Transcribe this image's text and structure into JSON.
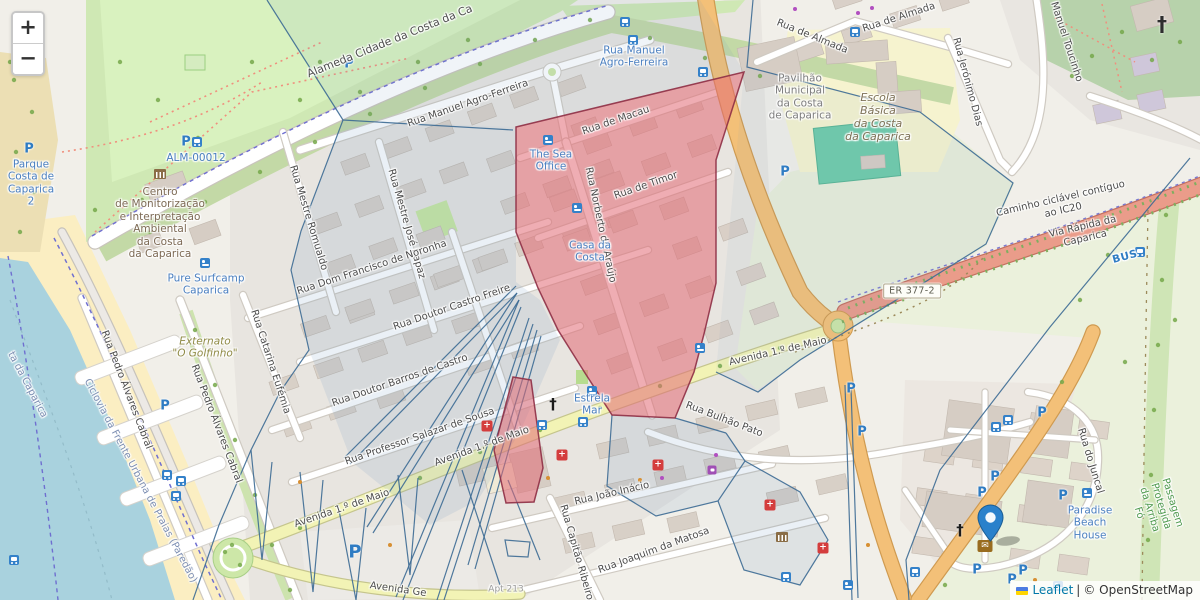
{
  "controls": {
    "zoom_in_label": "+",
    "zoom_out_label": "−"
  },
  "attribution": {
    "flag": "ukraine-flag",
    "leaflet_link": "Leaflet",
    "separator": "|",
    "osm_text": "© OpenStreetMap"
  },
  "route_badge": {
    "text": "ER 377-2"
  },
  "colors": {
    "highlight_fill": "#E26A74",
    "highlight_stroke": "#8E2F45",
    "overlay_line": "#3C6A94",
    "overlay_tint": "#6D94BD",
    "marker_blue": "#2A81CB",
    "water": "#A9D2DE",
    "beach": "#FBEEC2",
    "park_green": "#CFE8B4",
    "road_orange": "#F3C078",
    "road_yellow": "#F2F3B5",
    "road_trunk": "#EA9C8A",
    "poi_blue": "#4A7FC0"
  },
  "street_labels": [
    {
      "text": "Alameda Cidade da Costa da Ca",
      "x": 390,
      "y": 42,
      "rot": -22,
      "cls": "big"
    },
    {
      "text": "Rua Manuel Agro-Ferreira",
      "x": 468,
      "y": 104,
      "rot": -19
    },
    {
      "text": "Rua de Macau",
      "x": 616,
      "y": 121,
      "rot": -19
    },
    {
      "text": "Rua de Timor",
      "x": 646,
      "y": 186,
      "rot": -19
    },
    {
      "text": "Rua Norberto de Araújo",
      "x": 600,
      "y": 225,
      "rot": 78
    },
    {
      "text": "Rua Mestre Romualdo",
      "x": 308,
      "y": 218,
      "rot": 73
    },
    {
      "text": "Rua Mestre José Rapaz",
      "x": 406,
      "y": 224,
      "rot": 74
    },
    {
      "text": "Rua Dom Francisco de Noronha",
      "x": 372,
      "y": 268,
      "rot": -18
    },
    {
      "text": "Rua Doutor Castro Freire",
      "x": 452,
      "y": 308,
      "rot": -19
    },
    {
      "text": "Rua Doutor Barros de Castro",
      "x": 400,
      "y": 381,
      "rot": -19
    },
    {
      "text": "Rua Professor Salazar de Sousa",
      "x": 420,
      "y": 437,
      "rot": -19
    },
    {
      "text": "Rua Catarina Eufémia",
      "x": 270,
      "y": 362,
      "rot": 72
    },
    {
      "text": "Rua Pedro Álvares Cabral",
      "x": 126,
      "y": 390,
      "rot": 69
    },
    {
      "text": "Rua Pedro Álvares Cabral",
      "x": 216,
      "y": 424,
      "rot": 69
    },
    {
      "text": "Avenida 1.º de Maio",
      "x": 482,
      "y": 447,
      "rot": -20
    },
    {
      "text": "Avenida 1.º de Maio",
      "x": 342,
      "y": 509,
      "rot": -19
    },
    {
      "text": "Avenida 1.º de Maio",
      "x": 778,
      "y": 352,
      "rot": -13
    },
    {
      "text": "Rua Bulhão Pato",
      "x": 724,
      "y": 420,
      "rot": 21
    },
    {
      "text": "Rua João Inácio",
      "x": 612,
      "y": 494,
      "rot": -13
    },
    {
      "text": "Rua Joaquim da Matosa",
      "x": 654,
      "y": 551,
      "rot": -20
    },
    {
      "text": "Rua Capitão Ribeiro de",
      "x": 578,
      "y": 560,
      "rot": 74
    },
    {
      "text": "Avenida Ge",
      "x": 398,
      "y": 590,
      "rot": 8
    },
    {
      "text": "Rua de Almada",
      "x": 812,
      "y": 37,
      "rot": 22
    },
    {
      "text": "Rua de Almada",
      "x": 899,
      "y": 18,
      "rot": -18
    },
    {
      "text": "Rua Jerónimo Dias",
      "x": 967,
      "y": 82,
      "rot": 75
    },
    {
      "text": "Manuel Toucinho",
      "x": 1066,
      "y": 42,
      "rot": 72
    },
    {
      "text": "Caminho ciclável contíguo ao IC20",
      "x": 1062,
      "y": 205,
      "rot": -13
    },
    {
      "text": "Via Rápida da Caparica",
      "x": 1084,
      "y": 233,
      "rot": -13
    },
    {
      "text": "Rua do Juncal",
      "x": 1090,
      "y": 461,
      "rot": 73
    },
    {
      "text": "Ciclovia da Frente Urbana de Praias (Paredão)",
      "x": 140,
      "y": 481,
      "rot": 62,
      "cls": "slate"
    },
    {
      "text": "ta da Caparica",
      "x": 27,
      "y": 385,
      "rot": 62,
      "cls": "slate"
    },
    {
      "text": "Apt 213",
      "x": 506,
      "y": 590,
      "rot": 0,
      "cls": "faint"
    },
    {
      "text": "BUS",
      "x": 1125,
      "y": 257,
      "rot": -15,
      "cls": "bus-lbl"
    }
  ],
  "poi_labels": [
    {
      "text": "Rua Manuel\nAgro-Ferreira",
      "x": 634,
      "y": 57,
      "cls": "blue"
    },
    {
      "text": "The Sea\nOffice",
      "x": 551,
      "y": 161,
      "cls": "blue"
    },
    {
      "text": "Casa da\nCosta",
      "x": 590,
      "y": 252,
      "cls": "blue"
    },
    {
      "text": "Pure Surfcamp\nCaparica",
      "x": 206,
      "y": 285,
      "cls": "blue"
    },
    {
      "text": "Parque\nCosta de\nCaparica\n2",
      "x": 31,
      "y": 183,
      "cls": "blue"
    },
    {
      "text": "ALM-00012",
      "x": 196,
      "y": 158,
      "cls": "blue"
    },
    {
      "text": "Estrela\nMar",
      "x": 592,
      "y": 405,
      "cls": "blue"
    },
    {
      "text": "Paradise\nBeach\nHouse",
      "x": 1090,
      "y": 523,
      "cls": "blue"
    },
    {
      "text": "Centro\nde Monitorização\ne Interpretação\nAmbiental\nda Costa\nda Caparica",
      "x": 160,
      "y": 223,
      "cls": "brown"
    },
    {
      "text": "Pavilhão\nMunicipal\nda Costa\nde Caparica",
      "x": 800,
      "y": 97,
      "cls": "gray"
    },
    {
      "text": "Escola\nBásica\nda Costa\nda Caparica",
      "x": 878,
      "y": 118,
      "cls": "brown-i"
    },
    {
      "text": "Externato\n\"O Golfinho\"",
      "x": 205,
      "y": 348,
      "cls": "olive-i"
    },
    {
      "text": "Passagem Protegida da Arriba Fó",
      "x": 1155,
      "y": 508,
      "cls": "green",
      "rot": 73
    }
  ],
  "icons": [
    {
      "type": "parking",
      "x": 29,
      "y": 149
    },
    {
      "type": "parking",
      "x": 349,
      "y": 64
    },
    {
      "type": "parking",
      "x": 785,
      "y": 172
    },
    {
      "type": "parking",
      "x": 165,
      "y": 406
    },
    {
      "type": "parking",
      "x": 851,
      "y": 389
    },
    {
      "type": "parking",
      "x": 862,
      "y": 432
    },
    {
      "type": "parking",
      "x": 1042,
      "y": 413
    },
    {
      "type": "parking",
      "x": 995,
      "y": 477
    },
    {
      "type": "parking",
      "x": 982,
      "y": 493
    },
    {
      "type": "parking",
      "x": 1063,
      "y": 496
    },
    {
      "type": "parking",
      "x": 977,
      "y": 570
    },
    {
      "type": "parking",
      "x": 1012,
      "y": 580
    },
    {
      "type": "parking",
      "x": 1023,
      "y": 571
    },
    {
      "type": "parking",
      "x": 186,
      "y": 142
    },
    {
      "type": "parking-lg",
      "x": 355,
      "y": 552
    },
    {
      "type": "bus",
      "x": 625,
      "y": 22
    },
    {
      "type": "bus",
      "x": 633,
      "y": 40
    },
    {
      "type": "bus",
      "x": 703,
      "y": 72
    },
    {
      "type": "bus",
      "x": 855,
      "y": 32
    },
    {
      "type": "bus",
      "x": 542,
      "y": 425
    },
    {
      "type": "bus",
      "x": 583,
      "y": 422
    },
    {
      "type": "bus",
      "x": 786,
      "y": 577
    },
    {
      "type": "bus",
      "x": 915,
      "y": 572
    },
    {
      "type": "bus",
      "x": 167,
      "y": 475
    },
    {
      "type": "bus",
      "x": 181,
      "y": 481
    },
    {
      "type": "bus",
      "x": 176,
      "y": 496
    },
    {
      "type": "bus",
      "x": 1008,
      "y": 420
    },
    {
      "type": "bus",
      "x": 996,
      "y": 427
    },
    {
      "type": "bus",
      "x": 197,
      "y": 142
    },
    {
      "type": "bus",
      "x": 14,
      "y": 560
    },
    {
      "type": "bus",
      "x": 1140,
      "y": 252
    },
    {
      "type": "pharmacy",
      "x": 487,
      "y": 426
    },
    {
      "type": "pharmacy",
      "x": 562,
      "y": 455
    },
    {
      "type": "pharmacy",
      "x": 658,
      "y": 465
    },
    {
      "type": "pharmacy",
      "x": 770,
      "y": 505
    },
    {
      "type": "pharmacy",
      "x": 823,
      "y": 548
    },
    {
      "type": "hotel",
      "x": 205,
      "y": 263
    },
    {
      "type": "hotel",
      "x": 548,
      "y": 140
    },
    {
      "type": "hotel",
      "x": 577,
      "y": 208
    },
    {
      "type": "hotel",
      "x": 592,
      "y": 391
    },
    {
      "type": "hotel",
      "x": 700,
      "y": 348
    },
    {
      "type": "hotel",
      "x": 1087,
      "y": 493
    },
    {
      "type": "hotel",
      "x": 848,
      "y": 585
    },
    {
      "type": "hotel",
      "x": 1058,
      "y": 586
    },
    {
      "type": "church",
      "x": 553,
      "y": 404
    },
    {
      "type": "church",
      "x": 960,
      "y": 530
    },
    {
      "type": "cemetery-cross",
      "x": 1162,
      "y": 24
    },
    {
      "type": "museum",
      "x": 160,
      "y": 174
    },
    {
      "type": "museum",
      "x": 782,
      "y": 537
    },
    {
      "type": "envelope",
      "x": 985,
      "y": 546
    },
    {
      "type": "cart",
      "x": 712,
      "y": 470
    },
    {
      "type": "dot-purple",
      "x": 795,
      "y": 9
    },
    {
      "type": "dot-purple",
      "x": 858,
      "y": 13
    },
    {
      "type": "dot-purple",
      "x": 872,
      "y": 8
    },
    {
      "type": "dot-purple",
      "x": 716,
      "y": 455
    },
    {
      "type": "dot-purple",
      "x": 662,
      "y": 478
    },
    {
      "type": "dot-orange",
      "x": 640,
      "y": 480
    },
    {
      "type": "dot-orange",
      "x": 548,
      "y": 478
    },
    {
      "type": "dot-orange",
      "x": 1035,
      "y": 580
    },
    {
      "type": "dot-orange",
      "x": 300,
      "y": 482
    },
    {
      "type": "dot-orange",
      "x": 868,
      "y": 545
    },
    {
      "type": "dot-orange",
      "x": 390,
      "y": 545
    }
  ],
  "marker": {
    "name": "map-marker",
    "x": 990,
    "y": 541
  }
}
